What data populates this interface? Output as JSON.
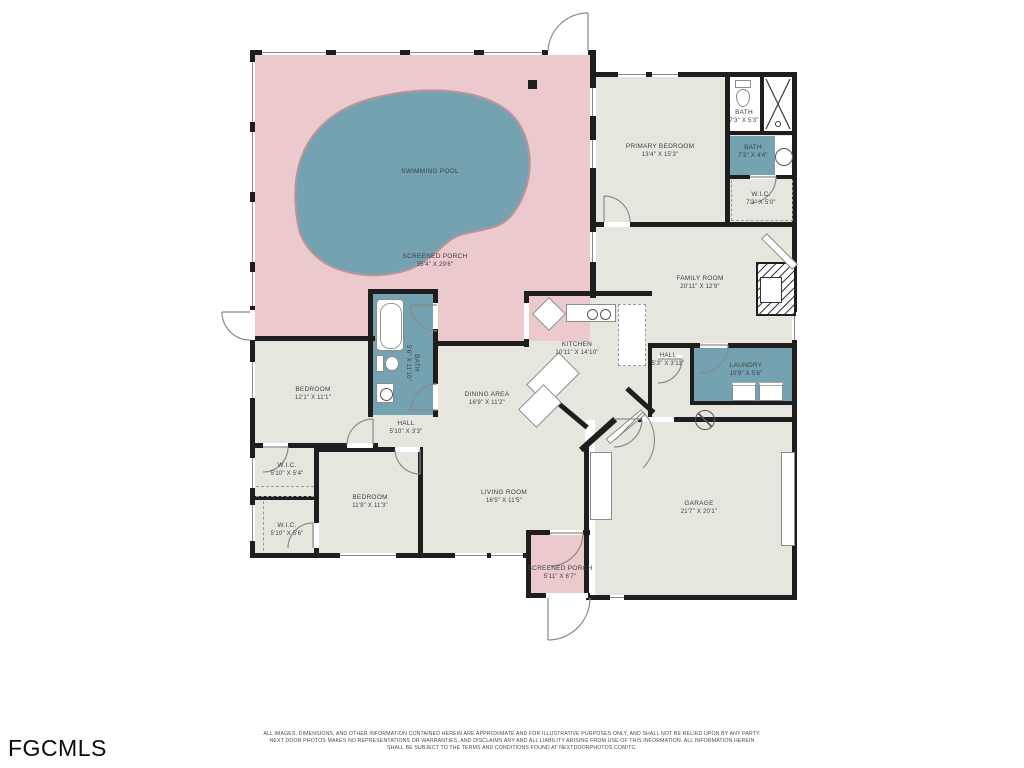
{
  "title": "Residential floor plan with swimming pool",
  "palette": {
    "porch_pink": "#ecc9cd",
    "pool_teal": "#74a2b0",
    "room_beige": "#e7e6de",
    "wet_room_teal": "#74a2b0",
    "wall_black": "#1e1e1e",
    "label_gray": "#3d4045"
  },
  "rooms": [
    {
      "name": "SWIMMING POOL",
      "dims": ""
    },
    {
      "name": "SCREENED PORCH",
      "dims": "35'4\" X 29'6\""
    },
    {
      "name": "PRIMARY BEDROOM",
      "dims": "13'4\" X 15'3\""
    },
    {
      "name": "BATH",
      "dims": "7'3\" X 5'3\""
    },
    {
      "name": "BATH",
      "dims": "7'3\" X 4'4\""
    },
    {
      "name": "W.I.C.",
      "dims": "7'3\" X 5'0\""
    },
    {
      "name": "FAMILY ROOM",
      "dims": "20'11\" X 12'9\""
    },
    {
      "name": "KITCHEN",
      "dims": "10'11\" X 14'10\""
    },
    {
      "name": "HALL",
      "dims": "5'3\" X 3'11\""
    },
    {
      "name": "LAUNDRY",
      "dims": "10'9\" X 5'6\""
    },
    {
      "name": "BEDROOM",
      "dims": "12'1\" X 11'1\""
    },
    {
      "name": "BATH",
      "dims": "5'6\" X 11'10\""
    },
    {
      "name": "HALL",
      "dims": "5'10\" X 3'3\""
    },
    {
      "name": "DINING AREA",
      "dims": "16'9\" X 11'2\""
    },
    {
      "name": "LIVING ROOM",
      "dims": "16'5\" X 11'5\""
    },
    {
      "name": "W.I.C.",
      "dims": "5'10\" X 5'4\""
    },
    {
      "name": "W.I.C.",
      "dims": "5'10\" X 5'6\""
    },
    {
      "name": "BEDROOM",
      "dims": "11'9\" X 11'3\""
    },
    {
      "name": "GARAGE",
      "dims": "21'7\" X 20'1\""
    },
    {
      "name": "SCREENED PORCH",
      "dims": "5'11\" X 6'7\""
    }
  ],
  "footer": {
    "logo": "FGCMLS",
    "disclaimer_line1": "ALL IMAGES, DIMENSIONS, AND OTHER INFORMATION CONTAINED HEREIN ARE APPROXIMATE AND FOR ILLUSTRATIVE PURPOSES ONLY, AND SHALL NOT BE RELIED UPON BY ANY PARTY.",
    "disclaimer_line2": "NEXT DOOR PHOTOS MAKES NO REPRESENTATIONS OR WARRANTIES, AND DISCLAIMS ANY AND ALL LIABILITY ARISING FROM USE OF THIS INFORMATION. ALL INFORMATION HEREIN",
    "disclaimer_line3": "SHALL BE SUBJECT TO THE TERMS AND CONDITIONS FOUND AT NEXTDOORPHOTOS.COM/TC."
  }
}
